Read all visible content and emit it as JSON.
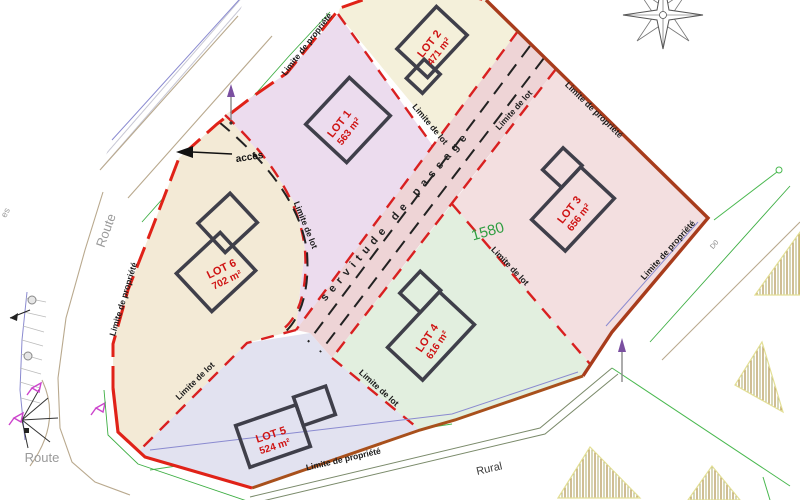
{
  "plan": {
    "lots": [
      {
        "name": "LOT 1",
        "area": "563 m²"
      },
      {
        "name": "LOT 2",
        "area": "471 m²"
      },
      {
        "name": "LOT 3",
        "area": "656 m²"
      },
      {
        "name": "LOT 4",
        "area": "616 m²"
      },
      {
        "name": "LOT 5",
        "area": "524 m²"
      },
      {
        "name": "LOT 6",
        "area": "702 m²"
      }
    ],
    "labels": {
      "property_limit": "Limite de propriété",
      "lot_limit": "Limite de lot",
      "servitude": "servitude de passage",
      "parcel_number": "1580",
      "access": "accès",
      "road": "Route",
      "rural_road": "Rural",
      "road_code": "D0",
      "left_road_fragment": "es"
    },
    "colors": {
      "property_line_red": "#e02218",
      "property_line_dark": "#a83c1c",
      "lot_limit_red": "#d92020",
      "lot1_fill": "#ecdcee",
      "lot2_fill": "#f4f0da",
      "lot3_fill": "#f3dfe0",
      "lot4_fill": "#e2efdf",
      "lot5_fill": "#e2e2f0",
      "lot6_fill": "#f3ead6",
      "servitude_fill": "#eed4d6",
      "parcel_number_green": "#2f9e41"
    }
  }
}
